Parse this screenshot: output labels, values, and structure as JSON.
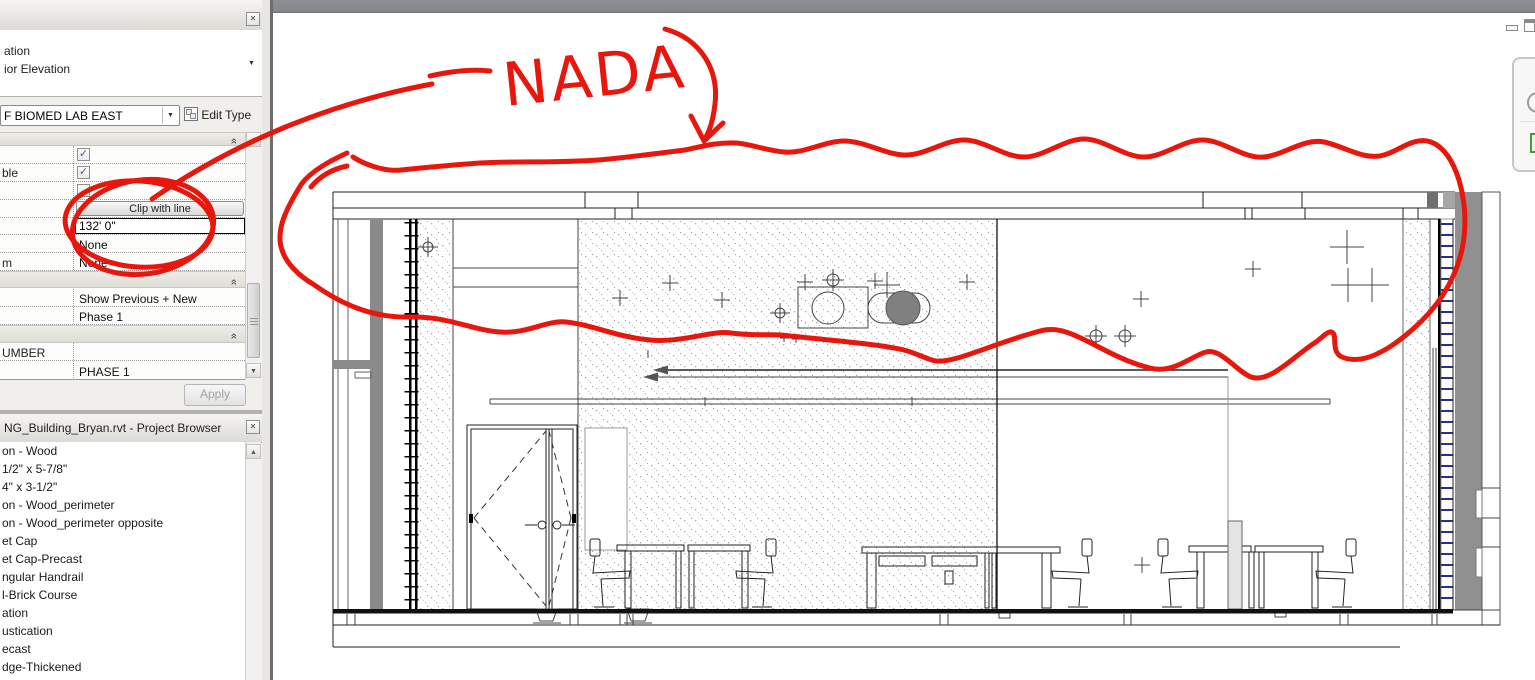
{
  "icons": {
    "close": "✕",
    "dropdown": "▼",
    "collapse_chevron": "»",
    "scroll_up": "▲",
    "scroll_down": "▼",
    "check": "✓"
  },
  "properties_panel": {
    "type_selector_line1": "ation",
    "type_selector_line2": "ior Elevation",
    "instance_selector_value": "F BIOMED LAB EAST",
    "edit_type_label": "Edit Type",
    "rows": {
      "check_row1_label": "",
      "check_row1_checked": true,
      "check_row2_label": "ble",
      "check_row2_checked": true,
      "check_row3_label": "",
      "check_row3_checked": false,
      "far_clipping_button": "Clip with line",
      "far_clip_offset": "132'  0\"",
      "scope_value_1": "None",
      "row_m_label": "m",
      "scope_value_2": "None",
      "phase_filter_value": "Show Previous + New",
      "phase_value": "Phase 1",
      "number_label": "UMBER",
      "number_value": "",
      "phase_caps_value": "PHASE 1"
    },
    "apply_label": "Apply"
  },
  "project_browser": {
    "title": "NG_Building_Bryan.rvt - Project Browser",
    "items": [
      "on - Wood",
      "1/2\" x 5-7/8\"",
      "4\" x 3-1/2\"",
      "on - Wood_perimeter",
      "on - Wood_perimeter opposite",
      "et Cap",
      "et Cap-Precast",
      "ngular Handrail",
      "l-Brick Course",
      "ation",
      "ustication",
      "ecast",
      "dge-Thickened"
    ]
  },
  "canvas": {
    "annotation_text": "NADA",
    "annotation_color": "#e8170d",
    "drawing_description": "interior elevation with door, tables, chairs and ceiling targets"
  }
}
